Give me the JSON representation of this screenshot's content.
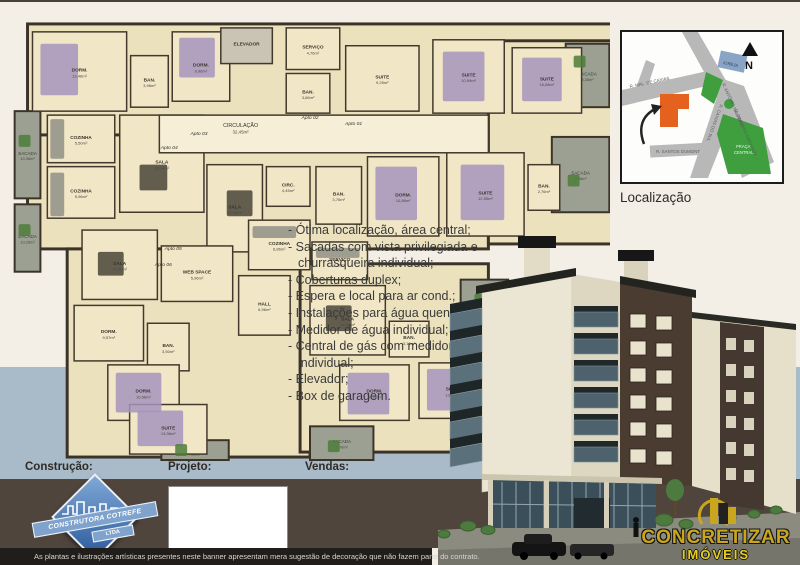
{
  "plan": {
    "bases": [
      [
        15,
        8,
        590,
        130
      ],
      [
        15,
        120,
        465,
        115
      ],
      [
        480,
        25,
        125,
        205
      ],
      [
        55,
        235,
        245,
        210
      ],
      [
        290,
        250,
        190,
        190
      ]
    ],
    "circulation": {
      "label": "CIRCULAÇÃO",
      "area": "32,45m²",
      "x": 230,
      "y": 112
    },
    "rooms": [
      {
        "label": "DORM.",
        "area": "13,46m²",
        "x": 20,
        "y": 16,
        "w": 95,
        "h": 80
      },
      {
        "label": "BAN.",
        "area": "3,96m²",
        "x": 119,
        "y": 40,
        "w": 38,
        "h": 52
      },
      {
        "label": "DORM.",
        "area": "9,96m²",
        "x": 161,
        "y": 16,
        "w": 58,
        "h": 70
      },
      {
        "label": "ELEVADOR",
        "area": "",
        "x": 210,
        "y": 12,
        "w": 52,
        "h": 36,
        "svc": true
      },
      {
        "label": "SERVIÇO",
        "area": "4,76m²",
        "x": 276,
        "y": 12,
        "w": 54,
        "h": 42
      },
      {
        "label": "BAN.",
        "area": "3,66m²",
        "x": 276,
        "y": 58,
        "w": 44,
        "h": 40
      },
      {
        "label": "SUITE",
        "area": "9,25m²",
        "x": 336,
        "y": 30,
        "w": 74,
        "h": 66
      },
      {
        "label": "SUITE",
        "area": "10,99m²",
        "x": 424,
        "y": 24,
        "w": 72,
        "h": 74
      },
      {
        "label": "SUITE",
        "area": "16,08m²",
        "x": 504,
        "y": 32,
        "w": 70,
        "h": 66
      },
      {
        "label": "COZINHA",
        "area": "5,50m²",
        "x": 35,
        "y": 100,
        "w": 68,
        "h": 48
      },
      {
        "label": "COZINHA",
        "area": "5,96m²",
        "x": 35,
        "y": 152,
        "w": 68,
        "h": 52
      },
      {
        "label": "SALA",
        "area": "20,14m²",
        "x": 108,
        "y": 100,
        "w": 85,
        "h": 98
      },
      {
        "label": "SALA",
        "area": "15,68m²",
        "x": 196,
        "y": 150,
        "w": 56,
        "h": 88
      },
      {
        "label": "CIRC.",
        "area": "4,45m²",
        "x": 256,
        "y": 152,
        "w": 44,
        "h": 40
      },
      {
        "label": "BAN.",
        "area": "3,76m²",
        "x": 306,
        "y": 152,
        "w": 46,
        "h": 58
      },
      {
        "label": "DORM.",
        "area": "10,86m²",
        "x": 358,
        "y": 142,
        "w": 72,
        "h": 80
      },
      {
        "label": "SUITE",
        "area": "12,55m²",
        "x": 438,
        "y": 138,
        "w": 78,
        "h": 84
      },
      {
        "label": "BAN.",
        "area": "2,76m²",
        "x": 520,
        "y": 150,
        "w": 32,
        "h": 46
      },
      {
        "label": "WEB SPACE",
        "area": "5,96m²",
        "x": 150,
        "y": 232,
        "w": 72,
        "h": 56
      },
      {
        "label": "SALA",
        "area": "21,50m²",
        "x": 70,
        "y": 216,
        "w": 76,
        "h": 70
      },
      {
        "label": "DORM.",
        "area": "9,57m²",
        "x": 62,
        "y": 292,
        "w": 70,
        "h": 56
      },
      {
        "label": "BAN.",
        "area": "3,50m²",
        "x": 136,
        "y": 310,
        "w": 42,
        "h": 48
      },
      {
        "label": "DORM.",
        "area": "10,56m²",
        "x": 96,
        "y": 352,
        "w": 72,
        "h": 56
      },
      {
        "label": "SUITE",
        "area": "13,96m²",
        "x": 118,
        "y": 392,
        "w": 78,
        "h": 50
      },
      {
        "label": "HALL",
        "area": "6,96m²",
        "x": 228,
        "y": 262,
        "w": 52,
        "h": 60
      },
      {
        "label": "COZINHA",
        "area": "6,86m²",
        "x": 238,
        "y": 206,
        "w": 62,
        "h": 50
      },
      {
        "label": "SERVIÇO",
        "area": "2,96m²",
        "x": 302,
        "y": 228,
        "w": 56,
        "h": 38
      },
      {
        "label": "SALA",
        "area": "18,66m²",
        "x": 300,
        "y": 272,
        "w": 76,
        "h": 70
      },
      {
        "label": "BAN.",
        "area": "3,16m²",
        "x": 380,
        "y": 308,
        "w": 40,
        "h": 36
      },
      {
        "label": "DORM.",
        "area": "10,96m²",
        "x": 330,
        "y": 352,
        "w": 70,
        "h": 56
      },
      {
        "label": "SUITE",
        "area": "13,36m²",
        "x": 410,
        "y": 350,
        "w": 68,
        "h": 56
      }
    ],
    "sacadas": [
      {
        "label": "SACADA",
        "area": "10,36m²",
        "x": 2,
        "y": 96,
        "w": 26,
        "h": 88
      },
      {
        "label": "SACADA",
        "area": "10,26m²",
        "x": 2,
        "y": 190,
        "w": 26,
        "h": 68
      },
      {
        "label": "SACADA",
        "area": "8,36m²",
        "x": 558,
        "y": 28,
        "w": 44,
        "h": 64
      },
      {
        "label": "SACADA",
        "area": "9,66m²",
        "x": 544,
        "y": 122,
        "w": 58,
        "h": 76
      },
      {
        "label": "SACADA",
        "area": "7,56m²",
        "x": 452,
        "y": 266,
        "w": 48,
        "h": 58
      },
      {
        "label": "SACADA",
        "area": "7,76m²",
        "x": 300,
        "y": 414,
        "w": 64,
        "h": 34
      },
      {
        "label": "SACADA",
        "area": "7,36m²",
        "x": 150,
        "y": 428,
        "w": 68,
        "h": 20
      },
      {
        "label": "SACADA",
        "area": "8,06m²",
        "x": 478,
        "y": 416,
        "w": 54,
        "h": 30
      }
    ],
    "apartments": [
      {
        "label": "Apto 01",
        "x": 344,
        "y": 110
      },
      {
        "label": "Apto 02",
        "x": 300,
        "y": 104
      },
      {
        "label": "Apto 03",
        "x": 188,
        "y": 120
      },
      {
        "label": "Apto 04",
        "x": 158,
        "y": 134
      },
      {
        "label": "Apto 05",
        "x": 162,
        "y": 236
      },
      {
        "label": "Apto 06",
        "x": 152,
        "y": 252
      }
    ],
    "accents": [
      {
        "f": "#a694bd",
        "x": 28,
        "y": 28,
        "w": 38,
        "h": 52
      },
      {
        "f": "#a694bd",
        "x": 168,
        "y": 22,
        "w": 36,
        "h": 40
      },
      {
        "f": "#a694bd",
        "x": 434,
        "y": 36,
        "w": 42,
        "h": 50
      },
      {
        "f": "#a694bd",
        "x": 514,
        "y": 42,
        "w": 40,
        "h": 44
      },
      {
        "f": "#a694bd",
        "x": 452,
        "y": 150,
        "w": 44,
        "h": 56
      },
      {
        "f": "#a694bd",
        "x": 366,
        "y": 152,
        "w": 42,
        "h": 54
      },
      {
        "f": "#a694bd",
        "x": 104,
        "y": 360,
        "w": 46,
        "h": 40
      },
      {
        "f": "#a694bd",
        "x": 126,
        "y": 398,
        "w": 46,
        "h": 36
      },
      {
        "f": "#a694bd",
        "x": 338,
        "y": 360,
        "w": 42,
        "h": 42
      },
      {
        "f": "#a694bd",
        "x": 418,
        "y": 356,
        "w": 42,
        "h": 42
      },
      {
        "f": "#4a4438",
        "x": 128,
        "y": 150,
        "w": 28,
        "h": 26
      },
      {
        "f": "#4a4438",
        "x": 216,
        "y": 176,
        "w": 26,
        "h": 26
      },
      {
        "f": "#4a4438",
        "x": 316,
        "y": 292,
        "w": 26,
        "h": 26
      },
      {
        "f": "#4a4438",
        "x": 86,
        "y": 238,
        "w": 26,
        "h": 24
      },
      {
        "f": "#8f8f85",
        "x": 38,
        "y": 104,
        "w": 14,
        "h": 40
      },
      {
        "f": "#8f8f85",
        "x": 38,
        "y": 158,
        "w": 14,
        "h": 44
      },
      {
        "f": "#8f8f85",
        "x": 242,
        "y": 212,
        "w": 44,
        "h": 12
      },
      {
        "f": "#8f8f85",
        "x": 306,
        "y": 234,
        "w": 44,
        "h": 10
      },
      {
        "f": "#4e7d3a",
        "x": 6,
        "y": 120,
        "w": 12,
        "h": 12
      },
      {
        "f": "#4e7d3a",
        "x": 6,
        "y": 210,
        "w": 12,
        "h": 12
      },
      {
        "f": "#4e7d3a",
        "x": 566,
        "y": 40,
        "w": 12,
        "h": 12
      },
      {
        "f": "#4e7d3a",
        "x": 560,
        "y": 160,
        "w": 12,
        "h": 12
      },
      {
        "f": "#4e7d3a",
        "x": 466,
        "y": 280,
        "w": 12,
        "h": 12
      },
      {
        "f": "#4e7d3a",
        "x": 318,
        "y": 428,
        "w": 12,
        "h": 12
      },
      {
        "f": "#4e7d3a",
        "x": 164,
        "y": 432,
        "w": 12,
        "h": 12
      },
      {
        "f": "#4e7d3a",
        "x": 490,
        "y": 424,
        "w": 12,
        "h": 12
      }
    ]
  },
  "features": {
    "items": [
      "Ótima localização, área central;",
      "Sacadas com vista privilegiada e churrasqueira individual;",
      "Coberturas duplex;",
      "Espera e local para ar cond.;",
      "Instalações para água quente;",
      "Medidor de água individual;",
      "Central de gás com medidor individual;",
      "Elevador;",
      "Box de garagem."
    ]
  },
  "map": {
    "title": "Localização",
    "north": "N",
    "streets": [
      "R. MAL. DE CAXIAS",
      "R. ANTÔNIO NAVARRO",
      "R. PINHEIRO MACHADO",
      "R. CAXIAS DO SUL",
      "R. SANTOS DUMONT"
    ],
    "landmarks": {
      "igreja": "IGREJA",
      "praca_l1": "PRAÇA",
      "praca_l2": "CENTRAL"
    },
    "colors": {
      "building": "#e4621e",
      "green": "#3f9f3f",
      "road": "#b8b8b8",
      "church": "#8aa4c6"
    }
  },
  "footer": {
    "construction_label": "Construção:",
    "project_label": "Projeto:",
    "sales_label": "Vendas:",
    "fine_print": "As plantas e ilustrações artísticas presentes neste banner apresentam mera sugestão de decoração que não fazem parte do contrato.",
    "builder_logo": {
      "line1": "CONSTRUTORA COTREFE",
      "line2": "LTDA"
    },
    "sales_logo": {
      "line1": "CONCRETIZAR",
      "line2": "IMÓVEIS"
    }
  }
}
